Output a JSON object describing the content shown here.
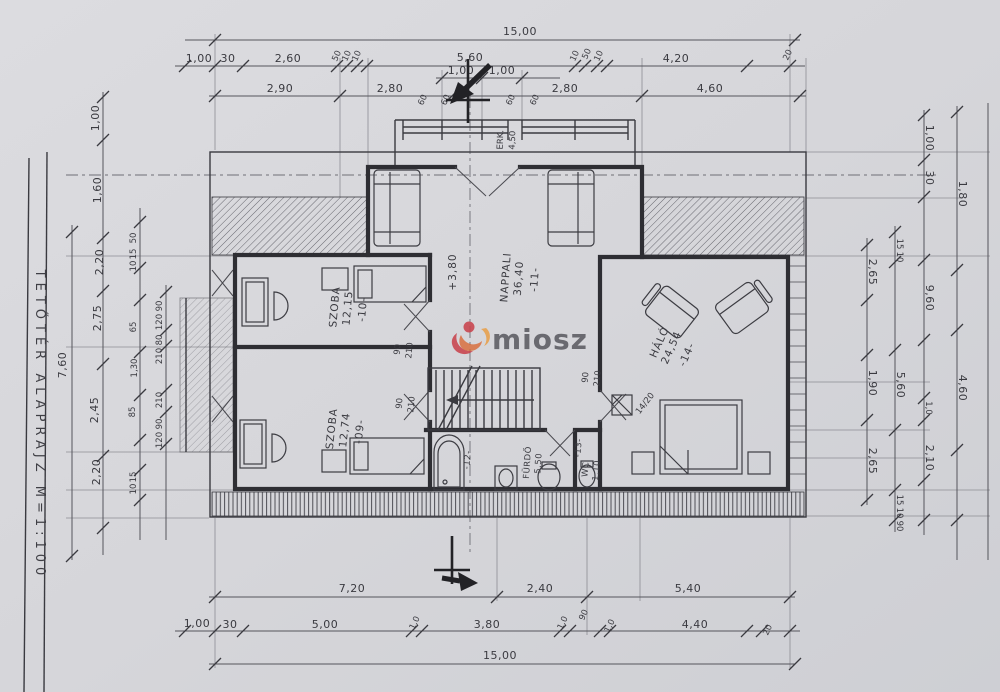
{
  "title": {
    "vertical_label": "TETŐTÉR  ALAPRAJZ  M=1:100"
  },
  "watermark": {
    "text": "miosz"
  },
  "colors": {
    "paper": "#d6d6da",
    "ink": "#34343a",
    "logo_red": "#c9444e",
    "logo_orange": "#e2913d",
    "watermark_text": "#5c5c62"
  },
  "rooms": {
    "r10": {
      "id": "-10-",
      "name": "SZOBA",
      "area": "12,15"
    },
    "r09": {
      "id": "-09-",
      "name": "SZOBA",
      "area": "12,74"
    },
    "r11": {
      "id": "-11-",
      "name": "NAPPALI",
      "area": "36,40",
      "level": "+3,80"
    },
    "r12": {
      "id": "-12-",
      "name": "FÜRDŐ",
      "area": "5,50"
    },
    "r13": {
      "id": "-13-",
      "name": "WC",
      "area": "1,10"
    },
    "r14": {
      "id": "-14-",
      "name": "HÁLÓ",
      "area": "24,54"
    }
  },
  "annotations": {
    "chimney": "14/20",
    "balcony_label": "ERK.",
    "balcony_dim": "4,50",
    "door_width": "90",
    "door_height": "210"
  },
  "dimensions": {
    "top_total": "15,00",
    "top_row1": [
      "1,00",
      "30",
      "2,60",
      "50",
      "10",
      "10",
      "5,60",
      "10",
      "50",
      "10",
      "4,20",
      "20"
    ],
    "top_dormer": [
      "1,00",
      "1,00"
    ],
    "window_marks": [
      "60",
      "60",
      "60",
      "60"
    ],
    "top_row2": [
      "2,90",
      "2,80",
      "2,80",
      "4,60"
    ],
    "bottom_row1": [
      "7,20",
      "2,40",
      "5,40"
    ],
    "bottom_row2": [
      "1,00",
      "30",
      "5,00",
      "1,0",
      "3,80",
      "1,0",
      "90",
      "1,0",
      "4,40",
      "20"
    ],
    "bottom_total": "15,00",
    "left_col1": [
      "7,60"
    ],
    "left_col2": [
      "1,00",
      "1,60",
      "2,20",
      "2,75",
      "2,45",
      "2,20"
    ],
    "left_col3": [
      "50",
      "15",
      "10",
      "65",
      "1,30",
      "85",
      "15",
      "10"
    ],
    "left_col4": [
      "90",
      "120",
      "80",
      "210",
      "210",
      "90",
      "120"
    ],
    "right_col1": [
      "2,65",
      "1,90",
      "2,65"
    ],
    "right_col2": [
      "15",
      "10",
      "5,60",
      "15",
      "10",
      "90"
    ],
    "right_col3": [
      "1,00",
      "30",
      "9,60",
      "1,0",
      "2,10"
    ],
    "right_col4": [
      "1,80",
      "4,60"
    ]
  }
}
